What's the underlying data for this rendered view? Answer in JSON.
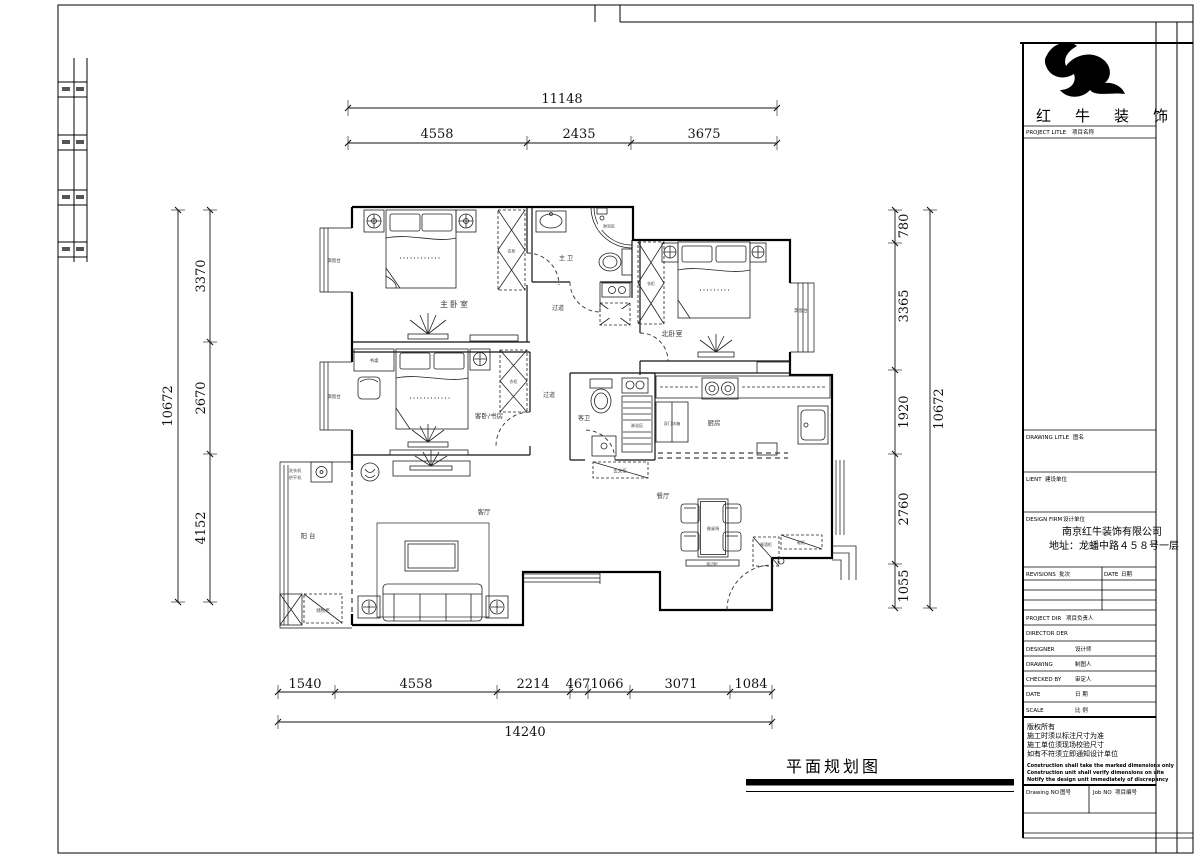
{
  "sheet": {
    "footer_title": "平面规划图"
  },
  "title_block": {
    "brand": "红牛装饰",
    "project_title_en": "PROJECT LITLE",
    "project_title_zh": "项目名称",
    "drawing_title_en": "DRAWING LITLE",
    "drawing_title_zh": "图名",
    "client_en": "LIENT",
    "client_zh": "建设单位",
    "design_firm_en": "DESIGN FIRM",
    "design_firm_zh": "设计单位",
    "company": "南京红牛装饰有限公司",
    "address": "地址：龙蟠中路４５８号一层",
    "revisions_en": "REVISIONS",
    "revisions_zh": "批次",
    "date_header_en": "DATE",
    "date_header_zh": "日期",
    "project_dir_en": "PROJECT DIR",
    "project_dir_zh": "项目负责人",
    "director_en": "DIRECTOR DER",
    "designer_en": "DESIGNER",
    "designer_zh": "设计师",
    "drawing_by_en": "DRAWING",
    "drawing_by_zh": "制图人",
    "checked_en": "CHECKED BY",
    "checked_zh": "审定人",
    "date_en": "DATE",
    "date_zh": "日  期",
    "scale_en": "SCALE",
    "scale_zh": "比  例",
    "notes": [
      "版权所有",
      "施工时须以标注尺寸为准",
      "施工单位须现场校验尺寸",
      "如有不符须立即通知设计单位"
    ],
    "notes_en": [
      "Construction shall take the marked dimensions only",
      "Construction unit shall verify dimensions on site",
      "Notify the design unit immediately of discrepancy"
    ],
    "drawing_no_en": "Drawing NO",
    "drawing_no_zh": "图号",
    "job_no_en": "Job NO",
    "job_no_zh": "项目编号"
  },
  "dims": {
    "top": {
      "total": "11148",
      "segments": [
        "4558",
        "2435",
        "3675"
      ]
    },
    "bottom": {
      "total": "14240",
      "segments": [
        "1540",
        "4558",
        "2214",
        "467",
        "1066",
        "3071",
        "1084"
      ]
    },
    "left": {
      "total": "10672",
      "segments": [
        "3370",
        "2670",
        "4152"
      ]
    },
    "right": {
      "total": "10672",
      "segments": [
        "780",
        "3365",
        "1920",
        "2760",
        "1055"
      ]
    }
  },
  "rooms": {
    "master_bedroom": "主卧室",
    "north_bedroom": "北卧室",
    "guest_bedroom": "客卧/书房",
    "master_bath": "主 卫",
    "guest_bath": "客卫",
    "corridor": "过道",
    "kitchen": "厨房",
    "dining": "餐厅",
    "living": "客厅",
    "balcony": "阳 台"
  },
  "furniture": {
    "bay_window": "飘窗台",
    "desk": "书桌",
    "washer_l1": "洗衣机",
    "washer_l2": "烘干机",
    "storage": "储物柜",
    "fridge": "双门冰箱",
    "shower": "淋浴区",
    "entry_cabinet": "玄关柜",
    "dining_set": "餐桌椅",
    "sideboard": "餐边柜",
    "wine_cabinet": "餐酒柜",
    "shoe_cabinet": "鞋柜",
    "wardrobe": "衣柜"
  }
}
